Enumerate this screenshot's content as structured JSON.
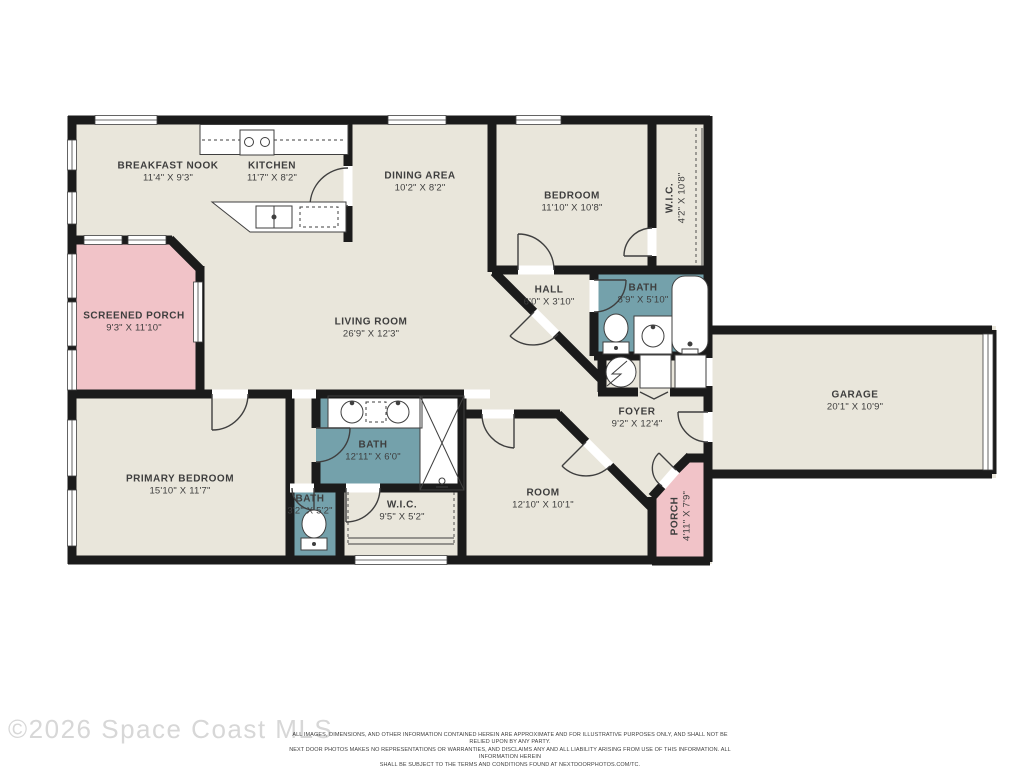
{
  "plan": {
    "title": "Residential floor plan",
    "colors": {
      "floor": "#e9e6db",
      "bath": "#74a1ab",
      "porch": "#f1c3c8",
      "wall": "#1b1b1b"
    },
    "rooms": [
      {
        "id": "breakfast-nook",
        "name": "BREAKFAST NOOK",
        "dims": "11'4\" X 9'3\""
      },
      {
        "id": "kitchen",
        "name": "KITCHEN",
        "dims": "11'7\" X 8'2\""
      },
      {
        "id": "dining-area",
        "name": "DINING AREA",
        "dims": "10'2\" X 8'2\""
      },
      {
        "id": "bedroom",
        "name": "BEDROOM",
        "dims": "11'10\" X 10'8\""
      },
      {
        "id": "wic-bedroom",
        "name": "W.I.C.",
        "dims": "4'2\" X 10'8\""
      },
      {
        "id": "screened-porch",
        "name": "SCREENED PORCH",
        "dims": "9'3\" X 11'10\""
      },
      {
        "id": "living-room",
        "name": "LIVING ROOM",
        "dims": "26'9\" X 12'3\""
      },
      {
        "id": "hall",
        "name": "HALL",
        "dims": "6'0\" X 3'10\""
      },
      {
        "id": "bath-hall",
        "name": "BATH",
        "dims": "8'9\" X 5'10\""
      },
      {
        "id": "garage",
        "name": "GARAGE",
        "dims": "20'1\" X 10'9\""
      },
      {
        "id": "foyer",
        "name": "FOYER",
        "dims": "9'2\" X 12'4\""
      },
      {
        "id": "primary-bedroom",
        "name": "PRIMARY BEDROOM",
        "dims": "15'10\" X 11'7\""
      },
      {
        "id": "bath-primary",
        "name": "BATH",
        "dims": "12'11\" X 6'0\""
      },
      {
        "id": "bath-small",
        "name": "BATH",
        "dims": "3'2\" X 5'2\""
      },
      {
        "id": "wic-primary",
        "name": "W.I.C.",
        "dims": "9'5\" X 5'2\""
      },
      {
        "id": "room",
        "name": "ROOM",
        "dims": "12'10\" X 10'1\""
      },
      {
        "id": "porch",
        "name": "PORCH",
        "dims": "4'11\" X 7'9\""
      }
    ]
  },
  "footer": {
    "copyright": "©2026 Space Coast MLS",
    "disclaimer_lines": [
      "ALL IMAGES, DIMENSIONS, AND OTHER INFORMATION CONTAINED HEREIN ARE APPROXIMATE AND FOR ILLUSTRATIVE PURPOSES ONLY, AND SHALL NOT BE RELIED UPON BY ANY PARTY.",
      "NEXT DOOR PHOTOS MAKES NO REPRESENTATIONS OR WARRANTIES, AND DISCLAIMS ANY AND ALL LIABILITY ARISING FROM USE OF THIS INFORMATION. ALL INFORMATION HEREIN",
      "SHALL BE SUBJECT TO THE TERMS AND CONDITIONS FOUND AT NEXTDOORPHOTOS.COM/TC."
    ]
  }
}
